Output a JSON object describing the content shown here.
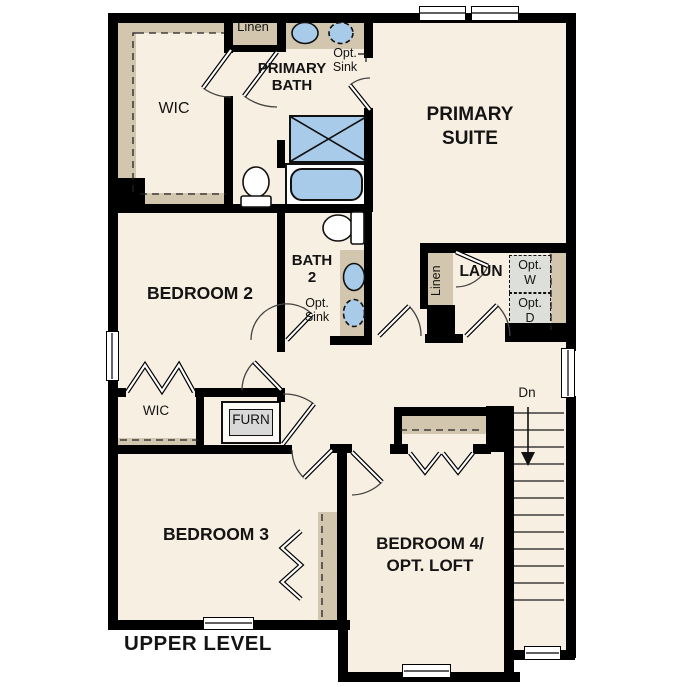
{
  "footer": {
    "level_title": "UPPER LEVEL"
  },
  "rooms": {
    "wic_upper": "WIC",
    "linen_upper": "Linen",
    "primary_bath": "PRIMARY\nBATH",
    "primary_suite": "PRIMARY\nSUITE",
    "bedroom2": "BEDROOM 2",
    "bath2": "BATH\n2",
    "laundry": "LAUN",
    "linen_laundry": "Linen",
    "wic_bedroom2": "WIC",
    "bedroom3": "BEDROOM 3",
    "bedroom4": "BEDROOM 4/\nOPT. LOFT"
  },
  "labels": {
    "opt_sink_primary": "Opt.\nSink",
    "opt_sink_bath2": "Opt.\nSink",
    "opt_washer": "Opt.\nW",
    "opt_dryer": "Opt.\nD",
    "furnace": "FURN",
    "stairs_down": "Dn"
  },
  "colors": {
    "floor": "#f7efe1",
    "cabinet": "#d2c6ae",
    "fixture": "#a9cbea",
    "optbox": "#dcdfda",
    "wall": "#000000"
  }
}
